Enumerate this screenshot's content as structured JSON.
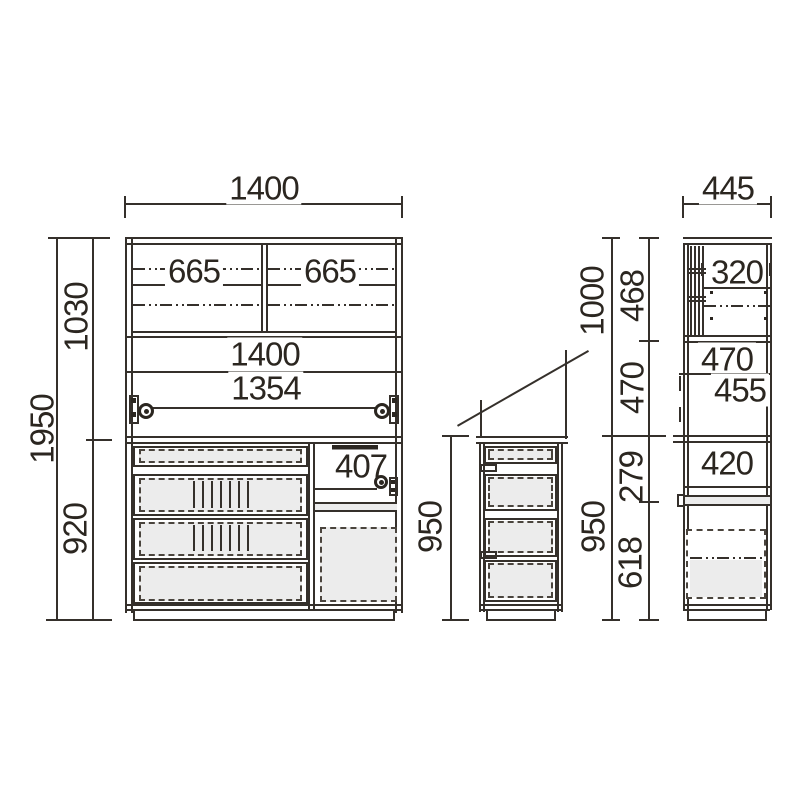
{
  "front_view": {
    "overall_width": "1400",
    "overall_height": "1950",
    "upper_section_height": "1030",
    "lower_section_height": "920",
    "sliding_door_left": "665",
    "sliding_door_right": "665",
    "counter_width": "1400",
    "opening_width": "1354",
    "niche_width": "407"
  },
  "lower_unit": {
    "height": "950"
  },
  "side_view": {
    "depth": "445",
    "upper_unit_height": "1000",
    "lower_unit_height": "950",
    "upper_inner_height": "468",
    "open_section_height": "470",
    "counter_section_height": "279",
    "door_section_height": "618",
    "upper_inner_depth": "320",
    "open_inner_height": "470",
    "counter_depth": "455",
    "lower_inner_height": "420"
  }
}
